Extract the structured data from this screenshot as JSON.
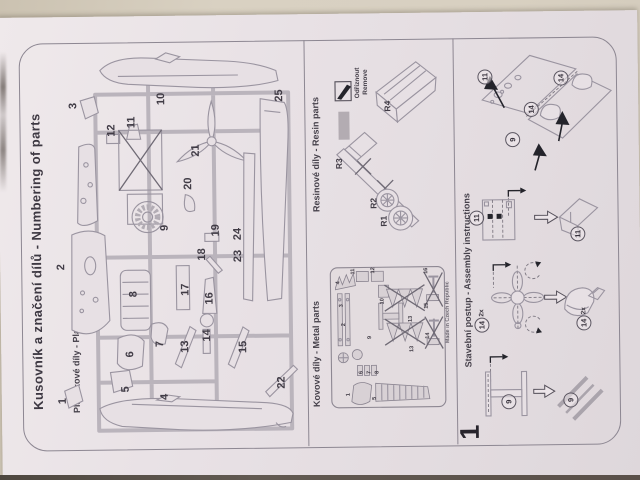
{
  "colors": {
    "wall": "#d8d0c1",
    "paper": "#e8e1e5",
    "line": "#8d8792",
    "ink": "#3d3842"
  },
  "header": {
    "title": "Kusovník a značení dílů - Numbering of parts"
  },
  "plastic": {
    "label": "Plastikové díly - Plastic parts",
    "parts": [
      {
        "n": "3",
        "x": 75,
        "y": 89
      },
      {
        "n": "12",
        "x": 113,
        "y": 114
      },
      {
        "n": "11",
        "x": 133,
        "y": 106
      },
      {
        "n": "10",
        "x": 163,
        "y": 83
      },
      {
        "n": "25",
        "x": 281,
        "y": 81
      },
      {
        "n": "21",
        "x": 197,
        "y": 135
      },
      {
        "n": "20",
        "x": 189,
        "y": 168
      },
      {
        "n": "9",
        "x": 165,
        "y": 212
      },
      {
        "n": "19",
        "x": 216,
        "y": 215
      },
      {
        "n": "24",
        "x": 238,
        "y": 219
      },
      {
        "n": "2",
        "x": 61,
        "y": 250
      },
      {
        "n": "18",
        "x": 202,
        "y": 239
      },
      {
        "n": "23",
        "x": 238,
        "y": 241
      },
      {
        "n": "8",
        "x": 133,
        "y": 278
      },
      {
        "n": "17",
        "x": 185,
        "y": 274
      },
      {
        "n": "16",
        "x": 209,
        "y": 283
      },
      {
        "n": "6",
        "x": 129,
        "y": 338
      },
      {
        "n": "7",
        "x": 159,
        "y": 328
      },
      {
        "n": "13",
        "x": 184,
        "y": 331
      },
      {
        "n": "14",
        "x": 206,
        "y": 320
      },
      {
        "n": "15",
        "x": 242,
        "y": 332
      },
      {
        "n": "5",
        "x": 124,
        "y": 373
      },
      {
        "n": "1",
        "x": 61,
        "y": 384
      },
      {
        "n": "4",
        "x": 163,
        "y": 381
      },
      {
        "n": "22",
        "x": 280,
        "y": 368
      }
    ]
  },
  "resin": {
    "label": "Resinové díly - Resin parts",
    "legend_cz": "Odříznout",
    "legend_en": "Remove",
    "parts": [
      {
        "n": "R4",
        "x": 389,
        "y": 93
      },
      {
        "n": "R3",
        "x": 340,
        "y": 150
      },
      {
        "n": "R2",
        "x": 374,
        "y": 190
      },
      {
        "n": "R1",
        "x": 384,
        "y": 208
      }
    ]
  },
  "metal": {
    "label": "Kovové díly - Metal parts",
    "fret_title": "HY 001/72/A FW-190",
    "made_in": "Made in Czech Republic",
    "parts": [
      {
        "n": "11",
        "x": 353,
        "y": 258
      },
      {
        "n": "12",
        "x": 373,
        "y": 257
      },
      {
        "n": "4",
        "x": 338,
        "y": 269
      },
      {
        "n": "3",
        "x": 341,
        "y": 292
      },
      {
        "n": "2",
        "x": 343,
        "y": 311
      },
      {
        "n": "10",
        "x": 382,
        "y": 288
      },
      {
        "n": "9",
        "x": 369,
        "y": 324
      },
      {
        "n": "6",
        "x": 360,
        "y": 359
      },
      {
        "n": "7",
        "x": 368,
        "y": 359
      },
      {
        "n": "8",
        "x": 376,
        "y": 359
      },
      {
        "n": "5",
        "x": 373,
        "y": 385
      },
      {
        "n": "1",
        "x": 347,
        "y": 381
      },
      {
        "n": "13",
        "x": 410,
        "y": 306
      },
      {
        "n": "13",
        "x": 411,
        "y": 336
      },
      {
        "n": "15",
        "x": 426,
        "y": 293
      },
      {
        "n": "14",
        "x": 427,
        "y": 323
      },
      {
        "n": "16",
        "x": 426,
        "y": 258
      }
    ]
  },
  "assembly": {
    "label": "Stavební postup - Assembly instructions",
    "step_number": "1",
    "callouts": [
      {
        "n": "11",
        "x": 487,
        "y": 65
      },
      {
        "n": "14",
        "x": 563,
        "y": 67
      },
      {
        "n": "14",
        "x": 533,
        "y": 98
      },
      {
        "n": "9",
        "x": 514,
        "y": 128
      },
      {
        "n": "11",
        "x": 477,
        "y": 206
      },
      {
        "n": "11",
        "x": 578,
        "y": 223
      },
      {
        "n": "14",
        "x": 481,
        "y": 309,
        "qty": "2x"
      },
      {
        "n": "14",
        "x": 583,
        "y": 308,
        "qty": "2x"
      },
      {
        "n": "9",
        "x": 507,
        "y": 390
      },
      {
        "n": "9",
        "x": 569,
        "y": 389
      }
    ]
  }
}
